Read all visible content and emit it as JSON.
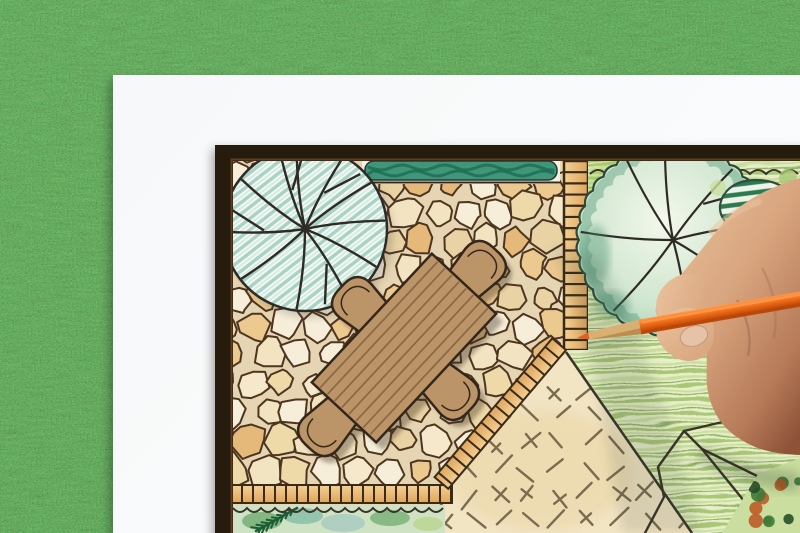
{
  "scene": {
    "title": "Landscape architect drawing a backyard garden design plan",
    "alt": "Top view of a hand holding an orange colored pencil while drawing a backyard garden landscape design plan on a white sheet of paper lying on green grass",
    "objects": [
      "green grass background",
      "white paper sheet",
      "garden plan drawing with dark frame border",
      "flagstone patio",
      "round shade tree symbol with hatched canopy",
      "clipped hedge band",
      "stepping stone ladder path",
      "rectangular garden table with four chairs",
      "scribbled green lawn",
      "large scalloped tree symbol",
      "striped shrub symbol",
      "dashed beige lawn panel",
      "planting bed with conifer sprig",
      "hand holding an orange colored pencil"
    ]
  },
  "palette": {
    "grass1": "#55924d",
    "grass2": "#2e6a31",
    "paper1": "#f6f8f9",
    "paper2": "#fbfcfd",
    "frame": "#281a10",
    "frame_inner": "#5e3b22",
    "grout": "#e6d5b2",
    "stone_line": "#4d3520",
    "plan_line": "#2e2a24",
    "ink": "#3a342a",
    "hedge_strip": "#f3f0e5",
    "hedge": "#3f967a",
    "hedge_dark": "#1d6b52",
    "ladder1": "#f4d094",
    "ladder2": "#dea55c",
    "path_line": "#3a2a18",
    "tree1_fill": "#f4faf6",
    "tree1_hatch": "#a9d2c4",
    "tree1_hatch2": "#d7ebe3",
    "tree2_core": "#f3f8ec",
    "tree2_mid": "#cfe6cf",
    "tree2_edge": "#9ecdb4",
    "tree2_scallop": "#489272",
    "tree2_stroke": "#2c4a3c",
    "shrub_fill": "#edf3e8",
    "shrub_stripe": "#2e7a50",
    "shrub_stroke": "#2e4e3e",
    "lawn_base": "#e7eec9",
    "lawn_s1": "#a9c876",
    "lawn_s2": "#cadf9f",
    "lawn_s3": "#8fb261",
    "lawn_bright": "#a6cf62",
    "beige": "#f2e5c4",
    "beige2": "#ead6a6",
    "dash": "#7b6b50",
    "bed_base": "#cfe3c4",
    "bed_teal": "#7fb9a4",
    "bed_green": "#6aa86c",
    "bed_blue": "#9fc6c0",
    "bed_yellow": "#b8d48e",
    "fir": "#1d5c34",
    "furn": "#bb9468",
    "furn_line": "#34261a",
    "plank": "#8a6844",
    "shadow": "#3c2f1f",
    "pencil_hi": "#ff9a4a",
    "pencil_mid": "#f4731d",
    "pencil_dark": "#c94f0c",
    "pencil_edge": "#b84708",
    "wood": "#d9af72",
    "wood_dark": "#bb8d4e",
    "pencil_tip": "#e2601c",
    "skin_hi": "#eac49e",
    "skin1": "#d8a57f",
    "skin2": "#b67a58",
    "skin3": "#8d5238",
    "nail": "#e6c3a8",
    "nail_edge": "#c79c80",
    "crease": "#9a6248",
    "mottle_orange": "#bc5c28",
    "mottle_green": "#3f7a38",
    "mottle_dark": "#274f28"
  },
  "layout": {
    "width": 800,
    "height": 533
  },
  "paper": {
    "x": 113,
    "y": 75
  },
  "frame": {
    "x": 215,
    "y": 145,
    "inner_x": 233,
    "inner_y": 161
  },
  "plan": {
    "patio": {
      "clip": "233,161 563,161 563,352 447,487 233,487",
      "x0": 220,
      "x1": 580,
      "y0": 152,
      "y1": 500,
      "step_x": 31,
      "step_y": 29,
      "rmin": 11,
      "rmax": 18,
      "seed": 7,
      "fills": [
        "#f7eed9",
        "#f2e4c0",
        "#eedaa9",
        "#ecc98f",
        "#f5e8cb",
        "#e9d3a4",
        "#f7eed9",
        "#e5b97a"
      ]
    },
    "tree_left": {
      "cx": 305,
      "cy": 229,
      "r": 82,
      "branches": [
        -96,
        -62,
        -35,
        -6,
        28,
        58,
        96,
        142,
        178,
        218,
        252
      ],
      "forks": [
        -62,
        58,
        178,
        252
      ]
    },
    "tree_right": {
      "cx": 673,
      "cy": 240,
      "r": 94,
      "scallops": 34,
      "amp": 6,
      "branches": [
        -95,
        -50,
        -10,
        35,
        80,
        130,
        185,
        240
      ],
      "forks": [
        -50,
        80
      ]
    },
    "shrub": {
      "cx": 757,
      "cy": 206
    },
    "hedge": {
      "x": 365,
      "y": 161,
      "w": 192,
      "h": 19
    },
    "ladder": {
      "x": 564,
      "y": 161,
      "w": 24,
      "h": 189,
      "rungs": 16
    },
    "edging": {
      "diag_x": 566,
      "diag_y": 350,
      "diag_len": 182,
      "diag_angle": 130.3,
      "band_w": 18,
      "tick": 11,
      "h_x0": 231,
      "h_x1": 452,
      "h_y": 485,
      "h_h": 18
    },
    "lawn_right": {
      "poly": "588,161 800,161 800,533 690,533 564,350 588,350"
    },
    "lawn_beige": {
      "poly": "566,350 690,533 438,533 438,505 449,487",
      "seed": 5
    },
    "boundary": {
      "x1": 566,
      "y1": 352,
      "x2": 692,
      "y2": 533
    },
    "top_bed_line": {
      "x0": 590,
      "x1": 806,
      "y": 174,
      "amp": 4,
      "period": 16
    },
    "bed": {
      "x": 231,
      "y": 505,
      "w": 214,
      "h": 28,
      "fir": {
        "x0": 256,
        "y0": 531,
        "x1": 297,
        "y1": 508,
        "pairs": 8
      }
    },
    "furniture": {
      "table": {
        "cx": 404,
        "cy": 348,
        "hw": 88,
        "hh": 44,
        "angle": -47,
        "planks": 8
      },
      "chairs": [
        {
          "cx": 360,
          "cy": 305,
          "angle": -47
        },
        {
          "cx": 478,
          "cy": 269,
          "angle": 43
        },
        {
          "cx": 451,
          "cy": 392,
          "angle": 133
        },
        {
          "cx": 326,
          "cy": 428,
          "angle": -137
        }
      ]
    },
    "corner_plant": {
      "clip": "758,474 800,458 800,533 722,533",
      "seed": 11,
      "dots": 16
    },
    "outlines": [
      "645,533 664,497 658,467 684,431 702,449",
      "684,431 744,417",
      "702,449 770,533",
      "702,449 800,497",
      "748,533 800,470"
    ]
  },
  "pencil": {
    "tip_x": 577,
    "tip_y": 338,
    "angle_deg": -9.9,
    "length": 255,
    "body_width": 15,
    "wood_length": 66,
    "tip_length": 14
  }
}
